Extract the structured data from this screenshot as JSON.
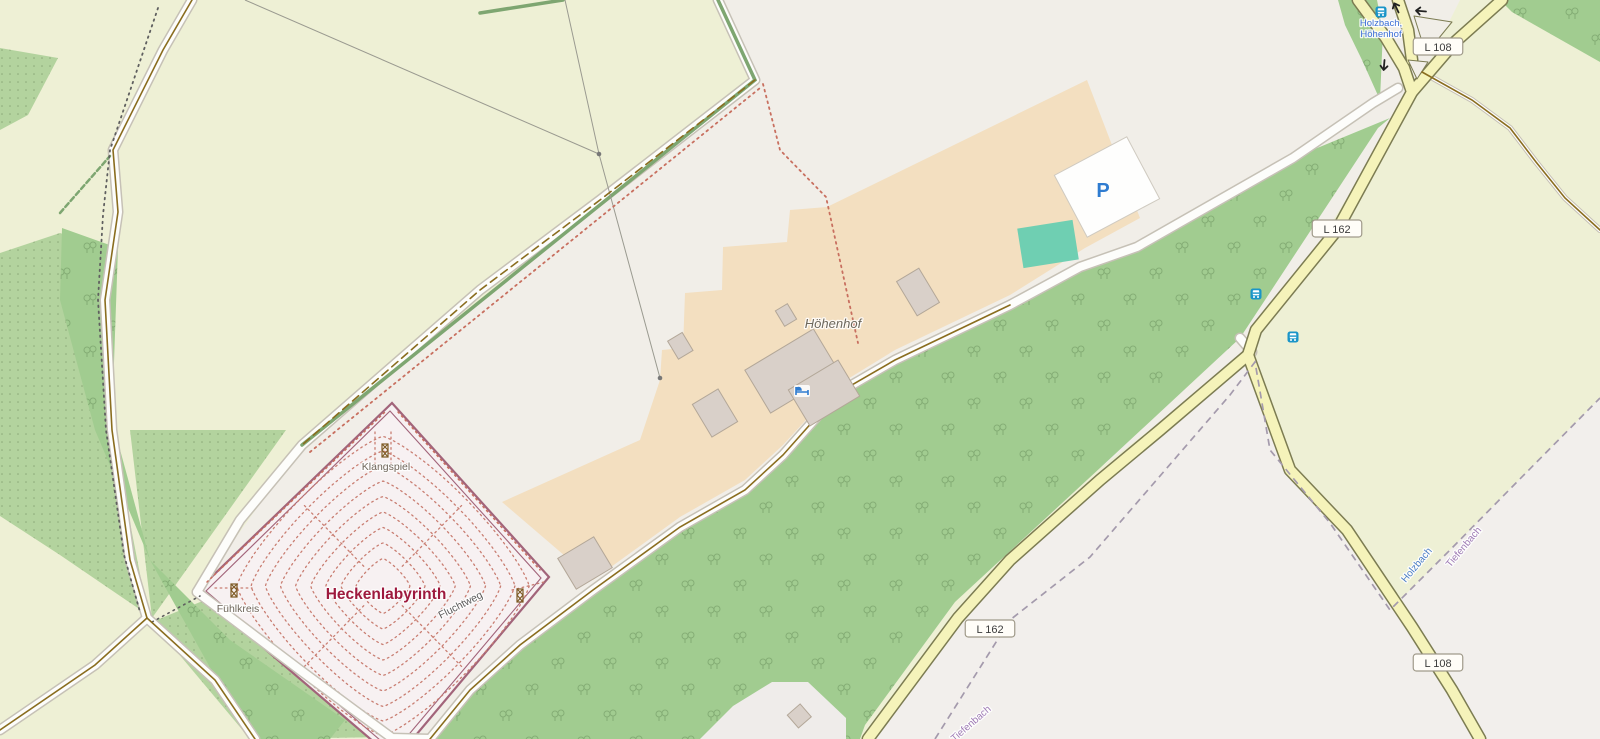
{
  "map": {
    "colors": {
      "farmland": "#eef0d5",
      "land": "#f1eee8",
      "land_east": "#f2efec",
      "forest": "#a1cc90",
      "tree_symbol": "#7da56e",
      "scrub": "#b3d39e",
      "farmyard": "#f3dfc0",
      "building": "#d9d0c9",
      "building_stroke": "#b3a798",
      "road_fill": "#f5f3ba",
      "road_casing": "#7c7c52",
      "track_fill": "#fdfdfb",
      "track_casing": "#c6c1b6",
      "track_line": "#8a6d1f",
      "path_dots_red": "#c86f5f",
      "path_dots_gray": "#5f5f5f",
      "maze_dots": "#c97e72",
      "labyrinth_wall": "#a2647a",
      "labyrinth_fill": "#f7f1f2",
      "hedge": "#7ea671",
      "boundary_line": "#a49aac",
      "pitch": "#6fcfb2",
      "parking_blue": "#2f7cd0",
      "bus_icon": "#1a95c8",
      "bus_label": "#3b6ed6",
      "stream_label": "#4d7fc6",
      "boundary_label": "#9f7bb5",
      "name_label": "#9e1a3e",
      "poi_label": "#6e665a",
      "farm_label": "#6d685c",
      "badge_text": "#3c3c3c",
      "badge_border": "#a09a8a",
      "power_line": "#9a9a90"
    },
    "road_badges": [
      {
        "ref": "L 108",
        "x": 1438,
        "y": 47
      },
      {
        "ref": "L 162",
        "x": 1337,
        "y": 229
      },
      {
        "ref": "L 162",
        "x": 990,
        "y": 629
      },
      {
        "ref": "L 108",
        "x": 1438,
        "y": 663
      }
    ],
    "bus_stop": {
      "name": "Holzbach, Höhenhof",
      "label_lines": [
        "Holzbach,",
        "Höhenhof"
      ],
      "label_x": 1381,
      "label_y": 26,
      "icon_x": 1381,
      "icon_y": 12
    },
    "bus_stop_icons": [
      {
        "x": 1256,
        "y": 294
      },
      {
        "x": 1293,
        "y": 337
      }
    ],
    "place_labels": [
      {
        "text": "Höhenhof",
        "x": 833,
        "y": 328,
        "rot": 0,
        "kind": "farm"
      },
      {
        "text": "Heckenlabyrinth",
        "x": 386,
        "y": 599,
        "rot": 0,
        "kind": "attraction-name"
      },
      {
        "text": "Klangspiel",
        "x": 386,
        "y": 470,
        "rot": 0,
        "kind": "poi"
      },
      {
        "text": "Fühlkreis",
        "x": 238,
        "y": 612,
        "rot": 0,
        "kind": "poi"
      },
      {
        "text": "Fluchtweg",
        "x": 462,
        "y": 608,
        "rot": -27,
        "kind": "path-name"
      },
      {
        "text": "Holzbach",
        "x": 1419,
        "y": 567,
        "rot": -50,
        "kind": "stream"
      },
      {
        "text": "Tiefenbach",
        "x": 1466,
        "y": 549,
        "rot": -50,
        "kind": "boundary"
      },
      {
        "text": "Tiefenbach",
        "x": 973,
        "y": 726,
        "rot": -41,
        "kind": "boundary"
      }
    ],
    "poi_icons": [
      {
        "type": "attraction",
        "x": 385,
        "y": 451
      },
      {
        "type": "attraction",
        "x": 234,
        "y": 591
      },
      {
        "type": "attraction",
        "x": 520,
        "y": 596
      },
      {
        "type": "guest-house",
        "x": 802,
        "y": 391
      }
    ],
    "parking_label": {
      "text": "P",
      "x": 1103,
      "y": 197
    },
    "oneway_arrows": [
      {
        "x": 1396,
        "y": 7,
        "rot": -115
      },
      {
        "x": 1420,
        "y": 11,
        "rot": -175
      },
      {
        "x": 1384,
        "y": 66,
        "rot": 95
      }
    ]
  }
}
